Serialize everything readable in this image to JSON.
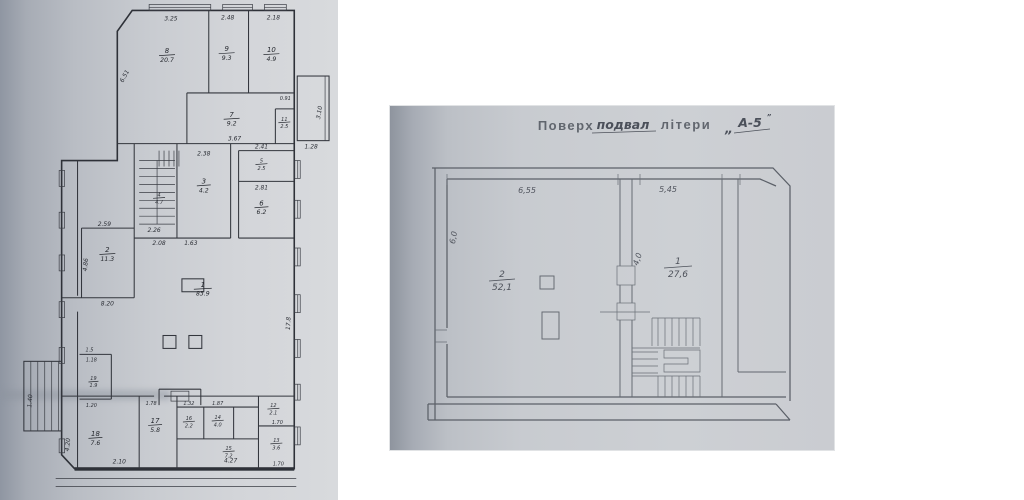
{
  "colors": {
    "page_bg": "#ffffff",
    "left_paper_dark": "#8f96a2",
    "left_paper_light": "#d8dadd",
    "left_ink": "#2e3138",
    "right_paper": "#c8cbd0",
    "right_paper_edge": "#8e949e",
    "right_ink": "#5b6068",
    "header_ink": "#565b64"
  },
  "left_plan": {
    "rooms": [
      {
        "n": "1",
        "a": "83.9"
      },
      {
        "n": "2",
        "a": "11.3"
      },
      {
        "n": "3",
        "a": "4.2"
      },
      {
        "n": "4",
        "a": "4.7"
      },
      {
        "n": "5",
        "a": "2.5"
      },
      {
        "n": "6",
        "a": "6.2"
      },
      {
        "n": "7",
        "a": "9.2"
      },
      {
        "n": "8",
        "a": "20.7"
      },
      {
        "n": "9",
        "a": "9.3"
      },
      {
        "n": "10",
        "a": "4.9"
      },
      {
        "n": "11",
        "a": "2.5"
      },
      {
        "n": "12",
        "a": "2.1"
      },
      {
        "n": "13",
        "a": "3.6"
      },
      {
        "n": "14",
        "a": "4.0"
      },
      {
        "n": "15",
        "a": "7.2"
      },
      {
        "n": "16",
        "a": "2.2"
      },
      {
        "n": "17",
        "a": "5.8"
      },
      {
        "n": "18",
        "a": "7.6"
      },
      {
        "n": "19",
        "a": "1.9"
      }
    ],
    "dims": {
      "top1": "3.25",
      "top2": "2.48",
      "top3": "2.18",
      "slant_left": "6.51",
      "annex_h": "3.10",
      "annex_b": "1.28",
      "closet": "0.91",
      "r7_b": "3.67",
      "r3_t": "2.38",
      "r5_t": "2.41",
      "r6_t": "2.81",
      "stair_b": "2.26",
      "hall_t1": "2.08",
      "hall_t2": "1.63",
      "r2_t": "2.59",
      "r2_l": "4.86",
      "r2_b": "8.20",
      "c1": "1.5",
      "c2": "1.18",
      "c3": "1.20",
      "ext_stair": "1.40",
      "b17": "1.78",
      "b16": "1.32",
      "b14": "1.87",
      "r18_b": "2.10",
      "r15_b": "4.27",
      "r13_b": "1.70",
      "r12_b": "1.70",
      "right_v": "17.8",
      "left_v": "4.20"
    }
  },
  "right_plan": {
    "header": {
      "stamp1": "Поверх",
      "hand1": "подвал",
      "stamp2": "літери",
      "quote": "„",
      "hand2": "А-5",
      "sup": "”"
    },
    "rooms": [
      {
        "n": "2",
        "a": "52,1"
      },
      {
        "n": "1",
        "a": "27,6"
      }
    ],
    "dims": {
      "top_left": "6,55",
      "top_right": "5,45",
      "left_v": "6,0",
      "mid_v": "4,0"
    }
  }
}
